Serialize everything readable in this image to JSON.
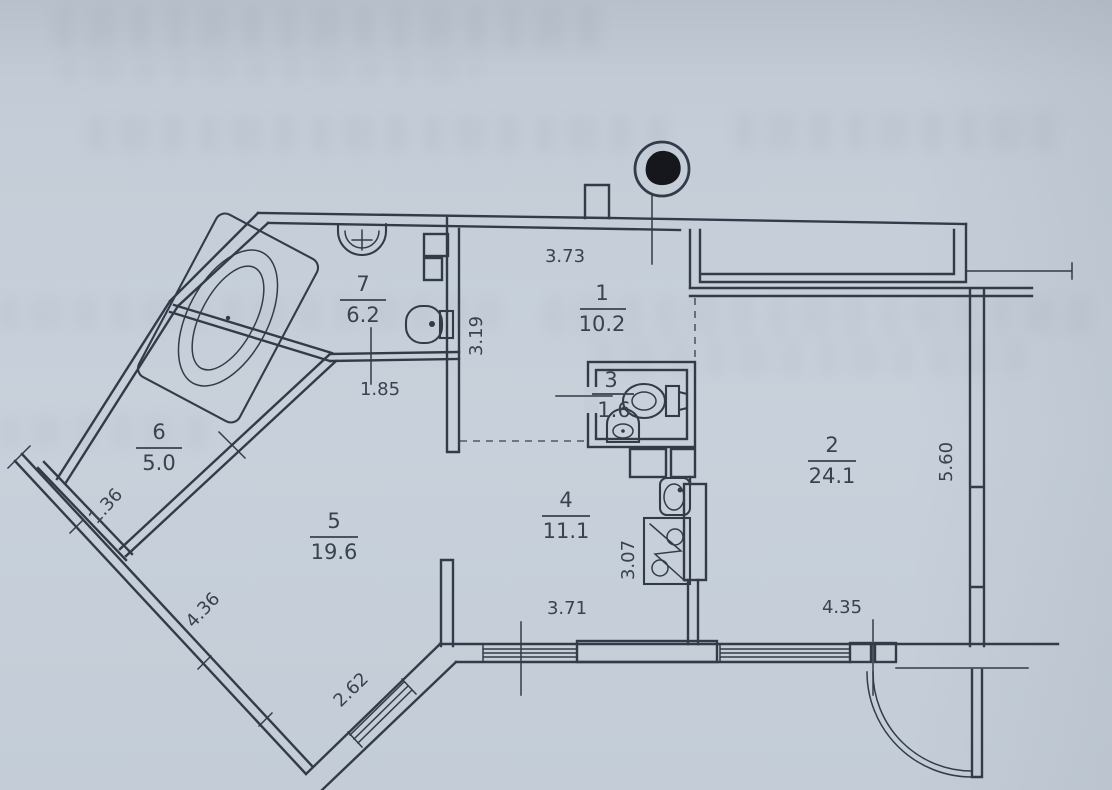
{
  "colors": {
    "paper": "#c5ced8",
    "ink": "#333b49",
    "stamp": "#15171c"
  },
  "rooms": [
    {
      "number": "1",
      "area": "10.2"
    },
    {
      "number": "2",
      "area": "24.1"
    },
    {
      "number": "3",
      "area": "1.6"
    },
    {
      "number": "4",
      "area": "11.1"
    },
    {
      "number": "5",
      "area": "19.6"
    },
    {
      "number": "6",
      "area": "5.0"
    },
    {
      "number": "7",
      "area": "6.2"
    }
  ],
  "dimensions": {
    "top_wall": "3.73",
    "hall_depth": "3.19",
    "bath_wall": "1.85",
    "loggia_end": "1.36",
    "outer_wall": "4.36",
    "bay_wall": "2.62",
    "kitchen_wall": "3.71",
    "kitchen_depth": "3.07",
    "living_wall": "4.35",
    "living_depth": "5.60"
  },
  "icons": {
    "stamp": "inked-seal-circle",
    "bathtub": "corner-bathtub",
    "bath_sink": "washbasin",
    "bath_toilet": "toilet",
    "wc_toilet": "toilet",
    "wc_sink": "corner-washbasin",
    "kitchen_sink": "kitchen-sink",
    "stove": "electric-stove",
    "door": "door-swing-arc"
  }
}
